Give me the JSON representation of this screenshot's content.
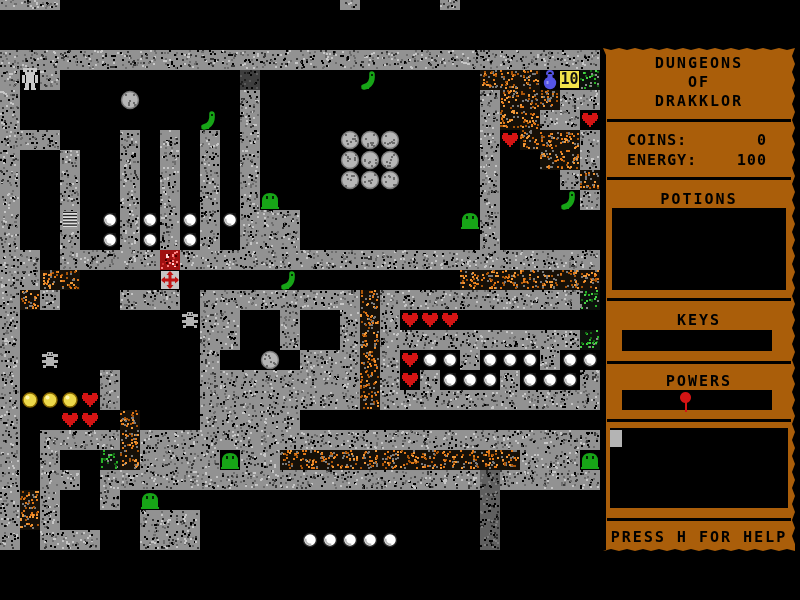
{
  "window": {
    "width": 800,
    "height": 600,
    "background": "#000000"
  },
  "sidebar": {
    "panel_color": "#AA5E0A",
    "text_color": "#000000",
    "title_lines": [
      "DUNGEONS",
      "OF",
      "DRAKKLOR"
    ],
    "stats": [
      {
        "label": "COINS:",
        "value": "0"
      },
      {
        "label": "ENERGY:",
        "value": "100"
      }
    ],
    "potions_label": "POTIONS",
    "keys_label": "KEYS",
    "powers_label": "POWERS",
    "help_text": "PRESS H FOR HELP",
    "power_item": {
      "name": "balloon-power-icon",
      "color": "#d41414"
    },
    "inventory_cursor_color": "#b4b4b4"
  },
  "map": {
    "cols": 30,
    "rows": 31,
    "tile_w": 20,
    "tile_h": 20,
    "offset_y": -10,
    "legend": {
      "#": "stone-wall",
      ".": "floor",
      "o": "dirt-rubble",
      "g": "moss-wall",
      "d": "dark-door",
      "p": "dark-pillar"
    },
    "tiles": [
      "###..............#....#.......",
      "..............................",
      "..............................",
      "##############################",
      "#.#.........d...........ooo..g",
      "#...........#...........#ooo##",
      "#...........#...........#oo##.",
      "###...#.#.#.#...........#.ooo#",
      "#..#..#.#.#.#...........#..oo#",
      "#..#..#.#.#.#...........#...#o",
      "#..#..#.#.#.#...........#....#",
      "#..#..#.#.#.###.........#.....",
      "#..#..#.#.#.###.........#.....",
      "##.#####.#####################",
      "##oo...................ooooooo",
      "#o#...###.########o##########g",
      "#.........##..#..#o#..........",
      "#.........##..#..#o##########g",
      "#.........#....###o#...#...#..",
      "#....#....########o#.#...#...#",
      "#....#....########o###########",
      "#.....o...#####...............",
      "#.####o#######################",
      "#.#..go####.##oooooooooooo###.",
      "#.##.###################p#####",
      "#o#..#..................p.....",
      "#o#....###..............p.....",
      "#.###..###..............p.....",
      "..............................",
      "..............................",
      ".............................."
    ],
    "sprites": [
      {
        "type": "robot",
        "col": 1,
        "row": 4
      },
      {
        "type": "boulder",
        "col": 6,
        "row": 5
      },
      {
        "type": "boulder",
        "col": 17,
        "row": 7
      },
      {
        "type": "boulder",
        "col": 18,
        "row": 7
      },
      {
        "type": "boulder",
        "col": 19,
        "row": 7
      },
      {
        "type": "boulder",
        "col": 17,
        "row": 8
      },
      {
        "type": "boulder",
        "col": 18,
        "row": 8
      },
      {
        "type": "boulder",
        "col": 19,
        "row": 8
      },
      {
        "type": "boulder",
        "col": 17,
        "row": 9
      },
      {
        "type": "boulder",
        "col": 18,
        "row": 9
      },
      {
        "type": "boulder",
        "col": 19,
        "row": 9
      },
      {
        "type": "boulder",
        "col": 13,
        "row": 18
      },
      {
        "type": "worm",
        "col": 18,
        "row": 4
      },
      {
        "type": "worm",
        "col": 10,
        "row": 6
      },
      {
        "type": "worm",
        "col": 28,
        "row": 10
      },
      {
        "type": "worm",
        "col": 14,
        "row": 14
      },
      {
        "type": "slime",
        "col": 13,
        "row": 10
      },
      {
        "type": "slime",
        "col": 23,
        "row": 11
      },
      {
        "type": "slime",
        "col": 11,
        "row": 23
      },
      {
        "type": "slime",
        "col": 29,
        "row": 23
      },
      {
        "type": "slime",
        "col": 7,
        "row": 25
      },
      {
        "type": "heart",
        "col": 29,
        "row": 6
      },
      {
        "type": "heart",
        "col": 25,
        "row": 7
      },
      {
        "type": "heart",
        "col": 20,
        "row": 16
      },
      {
        "type": "heart",
        "col": 21,
        "row": 16
      },
      {
        "type": "heart",
        "col": 22,
        "row": 16
      },
      {
        "type": "heart",
        "col": 20,
        "row": 18
      },
      {
        "type": "heart",
        "col": 20,
        "row": 19
      },
      {
        "type": "heart",
        "col": 4,
        "row": 20
      },
      {
        "type": "heart",
        "col": 3,
        "row": 21
      },
      {
        "type": "heart",
        "col": 4,
        "row": 21
      },
      {
        "type": "pearl",
        "col": 5,
        "row": 11
      },
      {
        "type": "pearl",
        "col": 7,
        "row": 11
      },
      {
        "type": "pearl",
        "col": 9,
        "row": 11
      },
      {
        "type": "pearl",
        "col": 11,
        "row": 11
      },
      {
        "type": "pearl",
        "col": 5,
        "row": 12
      },
      {
        "type": "pearl",
        "col": 7,
        "row": 12
      },
      {
        "type": "pearl",
        "col": 9,
        "row": 12
      },
      {
        "type": "pearl",
        "col": 21,
        "row": 18
      },
      {
        "type": "pearl",
        "col": 22,
        "row": 18
      },
      {
        "type": "pearl",
        "col": 24,
        "row": 18
      },
      {
        "type": "pearl",
        "col": 25,
        "row": 18
      },
      {
        "type": "pearl",
        "col": 26,
        "row": 18
      },
      {
        "type": "pearl",
        "col": 28,
        "row": 18
      },
      {
        "type": "pearl",
        "col": 29,
        "row": 18
      },
      {
        "type": "pearl",
        "col": 22,
        "row": 19
      },
      {
        "type": "pearl",
        "col": 23,
        "row": 19
      },
      {
        "type": "pearl",
        "col": 24,
        "row": 19
      },
      {
        "type": "pearl",
        "col": 26,
        "row": 19
      },
      {
        "type": "pearl",
        "col": 27,
        "row": 19
      },
      {
        "type": "pearl",
        "col": 28,
        "row": 19
      },
      {
        "type": "pearl",
        "col": 15,
        "row": 27
      },
      {
        "type": "pearl",
        "col": 16,
        "row": 27
      },
      {
        "type": "pearl",
        "col": 17,
        "row": 27
      },
      {
        "type": "pearl",
        "col": 18,
        "row": 27
      },
      {
        "type": "pearl",
        "col": 19,
        "row": 27
      },
      {
        "type": "coin",
        "col": 1,
        "row": 20
      },
      {
        "type": "coin",
        "col": 2,
        "row": 20
      },
      {
        "type": "coin",
        "col": 3,
        "row": 20
      },
      {
        "type": "spider",
        "col": 9,
        "row": 16
      },
      {
        "type": "spider",
        "col": 2,
        "row": 18
      },
      {
        "type": "ladder",
        "col": 3,
        "row": 11
      },
      {
        "type": "gift",
        "col": 8,
        "row": 13
      },
      {
        "type": "medkit",
        "col": 8,
        "row": 14
      },
      {
        "type": "flask",
        "col": 27,
        "row": 4
      },
      {
        "type": "badge",
        "col": 28,
        "row": 4,
        "text": "10"
      }
    ],
    "palette": {
      "floor": "#000000",
      "wall_base": "#929292",
      "wall_speckles": [
        "#3a3a3a",
        "#000000",
        "#c6c6c6",
        "#6e6e6e"
      ],
      "rubble_base": "#161008",
      "rubble_speckles": [
        "#e07818",
        "#a85408",
        "#f09838",
        "#7a7a7a"
      ],
      "moss_base": "#0c120c",
      "moss_speckles": [
        "#28b428",
        "#156815",
        "#46d446",
        "#8a8a8a"
      ],
      "door_base": "#3e3e3e",
      "door_speckles": [
        "#000000",
        "#1e1e1e",
        "#5a5a5a"
      ],
      "pillar_base": "#5f5f5f",
      "pillar_speckles": [
        "#000000",
        "#2c2c2c",
        "#7c7c7c"
      ],
      "slime_green": "#17a517",
      "heart_red": "#d41414",
      "coin_yellow": "#ecd84a",
      "pearl_white": "#ffffff",
      "boulder_gray": "#b6b6b6",
      "robot_gray": "#c8c8c8",
      "spider_gray": "#b2b2b2",
      "flask_blue": "#5454e6",
      "badge_yellow": "#f2e24a",
      "gift_red": "#a01010",
      "gift_speckles": [
        "#ff8484",
        "#4a0000",
        "#ffd6d6",
        "#d03030"
      ],
      "medkit_gray": "#c6c6c6",
      "cross_red": "#c01414"
    }
  }
}
